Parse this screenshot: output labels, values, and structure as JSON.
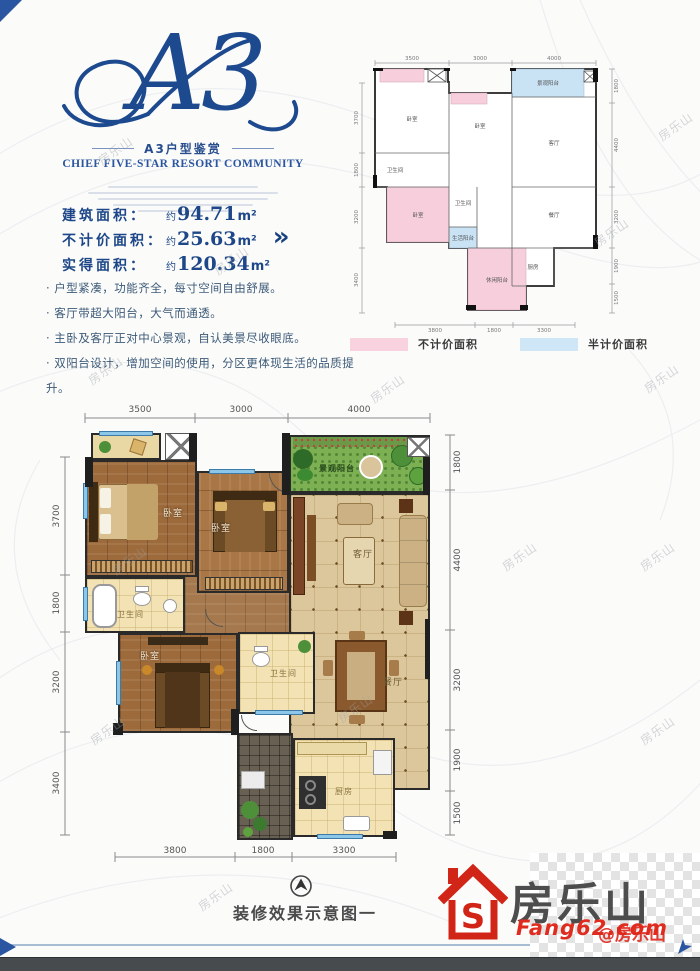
{
  "page": {
    "watermark": "房乐山"
  },
  "header": {
    "unit": "A3",
    "subtitle": "A3户型鉴赏",
    "tagline": "CHIEF FIVE-STAR RESORT COMMUNITY"
  },
  "area": {
    "rows": [
      {
        "label": "建筑面积：",
        "approx": "约",
        "value": "94.71",
        "unit": "m²"
      },
      {
        "label": "不计价面积：",
        "approx": "约",
        "value": "25.63",
        "unit": "m²"
      },
      {
        "label": "实得面积：",
        "approx": "约",
        "value": "120.34",
        "unit": "m²"
      }
    ],
    "arrow_icon": "»"
  },
  "features": [
    "· 户型紧凑，功能齐全，每寸空间自由舒展。",
    "· 客厅带超大阳台，大气而通透。",
    "· 主卧及客厅正对中心景观，自认美景尽收眼底。",
    "· 双阳台设计，增加空间的使用，分区更体现生活的品质提升。"
  ],
  "legend": {
    "no_charge": {
      "label": "不计价面积",
      "color": "#f8d2de"
    },
    "half_charge": {
      "label": "半计价面积",
      "color": "#cfe6f6"
    }
  },
  "dims": {
    "top": [
      "3500",
      "3000",
      "4000"
    ],
    "left": [
      "3700",
      "1800",
      "3200",
      "3400"
    ],
    "right": [
      "1800",
      "4400",
      "3200",
      "1900",
      "1500"
    ],
    "bottom": [
      "3800",
      "1800",
      "3300"
    ]
  },
  "rooms": {
    "bedroom1": "卧室",
    "bedroom2": "卧室",
    "bedroom3": "卧室",
    "living": "客厅",
    "dining": "餐厅",
    "kitchen": "厨房",
    "bath1": "卫生间",
    "bath2": "卫生间",
    "garden_balcony": "景观阳台",
    "service_balcony": "生活阳台",
    "leisure_balcony": "休闲阳台"
  },
  "footer": {
    "caption": "装修效果示意图一",
    "brand": "房乐山",
    "site": "Fang62.com",
    "overlay": "@房乐山"
  }
}
